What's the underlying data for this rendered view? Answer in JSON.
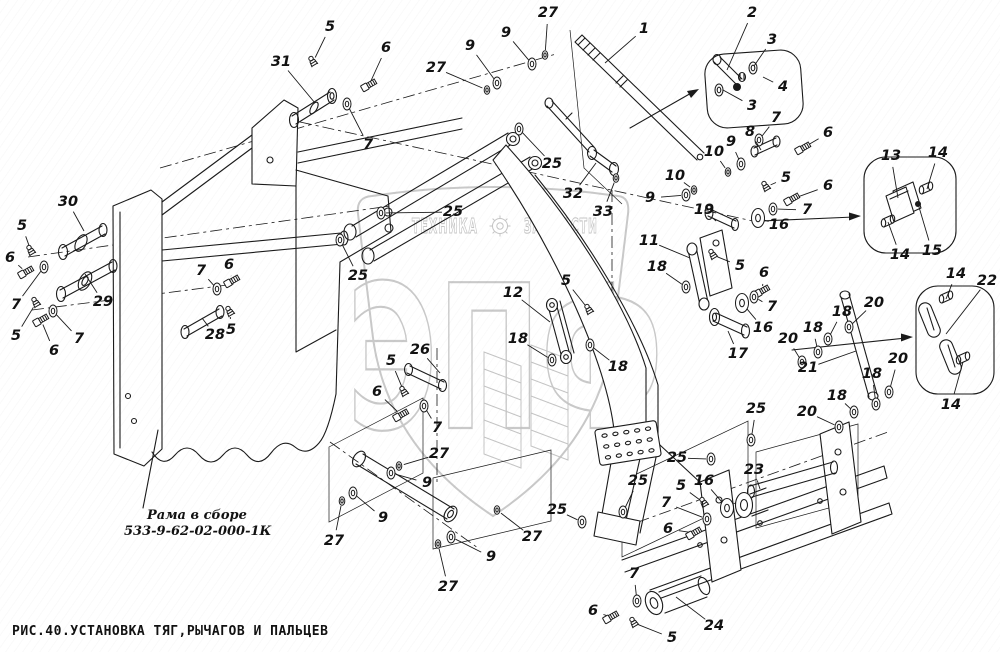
{
  "figure": {
    "caption": "РИС.40.УСТАНОВКА ТЯГ,РЫЧАГОВ И ПАЛЬЦЕВ",
    "frame_label": {
      "line1": "Рама в сборе",
      "line2": "533-9-62-02-000-1К"
    }
  },
  "watermark": {
    "word_left": "ТЕХНИКА",
    "word_right": "ЗАПЧАСТИ",
    "monogram": "ЭПФ",
    "gear_icon": "gear-icon",
    "color": "#c9c9c9"
  },
  "style": {
    "line_color": "#1a1a1a",
    "background": "#ffffff"
  },
  "callouts": [
    {
      "label": "5",
      "x": 330,
      "y": 27,
      "tx": 313,
      "ty": 62,
      "part": "fitting"
    },
    {
      "label": "6",
      "x": 386,
      "y": 48,
      "tx": 369,
      "ty": 85,
      "part": "bolt"
    },
    {
      "label": "31",
      "x": 281,
      "y": 62,
      "tx": 315,
      "ty": 103,
      "part": "none"
    },
    {
      "label": "7",
      "x": 368,
      "y": 145,
      "tx": 347,
      "ty": 104,
      "part": "washer"
    },
    {
      "label": "27",
      "x": 436,
      "y": 68,
      "tx": 487,
      "ty": 90,
      "part": "washer-s"
    },
    {
      "label": "9",
      "x": 470,
      "y": 46,
      "tx": 497,
      "ty": 83,
      "part": "washer"
    },
    {
      "label": "9",
      "x": 506,
      "y": 33,
      "tx": 532,
      "ty": 64,
      "part": "washer"
    },
    {
      "label": "27",
      "x": 548,
      "y": 13,
      "tx": 545,
      "ty": 55,
      "part": "washer-s"
    },
    {
      "label": "1",
      "x": 644,
      "y": 29,
      "tx": 605,
      "ty": 63,
      "part": "none"
    },
    {
      "label": "2",
      "x": 752,
      "y": 13,
      "tx": 727,
      "ty": 70,
      "part": "none"
    },
    {
      "label": "3",
      "x": 772,
      "y": 40,
      "tx": 754,
      "ty": 66,
      "part": "none"
    },
    {
      "label": "4",
      "x": 783,
      "y": 87,
      "tx": 763,
      "ty": 77,
      "part": "none"
    },
    {
      "label": "3",
      "x": 752,
      "y": 106,
      "tx": 723,
      "ty": 90,
      "part": "none"
    },
    {
      "label": "7",
      "x": 776,
      "y": 118,
      "tx": 759,
      "ty": 140,
      "part": "washer"
    },
    {
      "label": "6",
      "x": 828,
      "y": 133,
      "tx": 803,
      "ty": 148,
      "part": "bolt"
    },
    {
      "label": "8",
      "x": 750,
      "y": 132,
      "tx": 761,
      "ty": 150,
      "part": "none"
    },
    {
      "label": "9",
      "x": 731,
      "y": 142,
      "tx": 741,
      "ty": 164,
      "part": "washer"
    },
    {
      "label": "10",
      "x": 714,
      "y": 152,
      "tx": 728,
      "ty": 172,
      "part": "washer-s"
    },
    {
      "label": "10",
      "x": 675,
      "y": 176,
      "tx": 694,
      "ty": 190,
      "part": "washer-s"
    },
    {
      "label": "9",
      "x": 650,
      "y": 198,
      "tx": 686,
      "ty": 195,
      "part": "washer"
    },
    {
      "label": "5",
      "x": 786,
      "y": 178,
      "tx": 766,
      "ty": 187,
      "part": "fitting"
    },
    {
      "label": "6",
      "x": 828,
      "y": 186,
      "tx": 792,
      "ty": 199,
      "part": "bolt"
    },
    {
      "label": "7",
      "x": 807,
      "y": 210,
      "tx": 773,
      "ty": 209,
      "part": "washer"
    },
    {
      "label": "19",
      "x": 704,
      "y": 210,
      "tx": 716,
      "ty": 221,
      "part": "none"
    },
    {
      "label": "16",
      "x": 779,
      "y": 225,
      "tx": 758,
      "ty": 218,
      "part": "washer-b"
    },
    {
      "label": "13",
      "x": 891,
      "y": 156,
      "tx": 898,
      "ty": 198,
      "part": "none"
    },
    {
      "label": "14",
      "x": 938,
      "y": 153,
      "tx": 927,
      "ty": 189,
      "part": "none"
    },
    {
      "label": "15",
      "x": 932,
      "y": 251,
      "tx": 919,
      "ty": 207,
      "part": "none"
    },
    {
      "label": "14",
      "x": 900,
      "y": 255,
      "tx": 888,
      "ty": 222,
      "part": "none"
    },
    {
      "label": "14",
      "x": 956,
      "y": 274,
      "tx": 946,
      "ty": 299,
      "part": "none"
    },
    {
      "label": "22",
      "x": 987,
      "y": 281,
      "tx": 946,
      "ty": 334,
      "part": "none"
    },
    {
      "label": "14",
      "x": 951,
      "y": 405,
      "tx": 963,
      "ty": 362,
      "part": "none"
    },
    {
      "label": "20",
      "x": 874,
      "y": 303,
      "tx": 849,
      "ty": 327,
      "part": "washer"
    },
    {
      "label": "18",
      "x": 842,
      "y": 312,
      "tx": 828,
      "ty": 339,
      "part": "washer"
    },
    {
      "label": "18",
      "x": 813,
      "y": 328,
      "tx": 818,
      "ty": 352,
      "part": "washer"
    },
    {
      "label": "20",
      "x": 788,
      "y": 339,
      "tx": 802,
      "ty": 362,
      "part": "washer"
    },
    {
      "label": "21",
      "x": 808,
      "y": 368,
      "tx": 856,
      "ty": 351,
      "part": "none"
    },
    {
      "label": "20",
      "x": 898,
      "y": 359,
      "tx": 889,
      "ty": 392,
      "part": "washer"
    },
    {
      "label": "18",
      "x": 872,
      "y": 374,
      "tx": 876,
      "ty": 404,
      "part": "washer"
    },
    {
      "label": "18",
      "x": 837,
      "y": 396,
      "tx": 854,
      "ty": 412,
      "part": "washer"
    },
    {
      "label": "20",
      "x": 807,
      "y": 412,
      "tx": 839,
      "ty": 427,
      "part": "washer"
    },
    {
      "label": "32",
      "x": 573,
      "y": 194,
      "tx": 596,
      "ty": 163,
      "part": "none"
    },
    {
      "label": "33",
      "x": 603,
      "y": 212,
      "tx": 616,
      "ty": 178,
      "part": "washer-s"
    },
    {
      "label": "11",
      "x": 649,
      "y": 241,
      "tx": 690,
      "ty": 258,
      "part": "none"
    },
    {
      "label": "18",
      "x": 657,
      "y": 267,
      "tx": 686,
      "ty": 287,
      "part": "washer"
    },
    {
      "label": "5",
      "x": 740,
      "y": 266,
      "tx": 713,
      "ty": 255,
      "part": "fitting"
    },
    {
      "label": "6",
      "x": 764,
      "y": 273,
      "tx": 762,
      "ty": 291,
      "part": "bolt"
    },
    {
      "label": "7",
      "x": 772,
      "y": 307,
      "tx": 754,
      "ty": 297,
      "part": "washer"
    },
    {
      "label": "16",
      "x": 763,
      "y": 328,
      "tx": 742,
      "ty": 303,
      "part": "washer-b"
    },
    {
      "label": "17",
      "x": 738,
      "y": 354,
      "tx": 728,
      "ty": 331,
      "part": "none"
    },
    {
      "label": "12",
      "x": 513,
      "y": 293,
      "tx": 550,
      "ty": 322,
      "part": "none"
    },
    {
      "label": "5",
      "x": 566,
      "y": 281,
      "tx": 589,
      "ty": 310,
      "part": "fitting"
    },
    {
      "label": "18",
      "x": 518,
      "y": 339,
      "tx": 552,
      "ty": 360,
      "part": "washer"
    },
    {
      "label": "18",
      "x": 618,
      "y": 367,
      "tx": 590,
      "ty": 345,
      "part": "washer"
    },
    {
      "label": "25",
      "x": 552,
      "y": 164,
      "tx": 519,
      "ty": 129,
      "part": "washer"
    },
    {
      "label": "25",
      "x": 453,
      "y": 212,
      "tx": 381,
      "ty": 213,
      "part": "washer"
    },
    {
      "label": "25",
      "x": 358,
      "y": 276,
      "tx": 340,
      "ty": 240,
      "part": "washer"
    },
    {
      "label": "26",
      "x": 420,
      "y": 350,
      "tx": 440,
      "ty": 373,
      "part": "none"
    },
    {
      "label": "5",
      "x": 391,
      "y": 361,
      "tx": 404,
      "ty": 392,
      "part": "fitting"
    },
    {
      "label": "6",
      "x": 377,
      "y": 392,
      "tx": 401,
      "ty": 415,
      "part": "bolt"
    },
    {
      "label": "7",
      "x": 437,
      "y": 428,
      "tx": 424,
      "ty": 406,
      "part": "washer"
    },
    {
      "label": "27",
      "x": 439,
      "y": 454,
      "tx": 399,
      "ty": 466,
      "part": "washer-s"
    },
    {
      "label": "9",
      "x": 427,
      "y": 483,
      "tx": 391,
      "ty": 473,
      "part": "washer"
    },
    {
      "label": "9",
      "x": 383,
      "y": 518,
      "tx": 353,
      "ty": 493,
      "part": "washer"
    },
    {
      "label": "27",
      "x": 334,
      "y": 541,
      "tx": 342,
      "ty": 501,
      "part": "washer-s"
    },
    {
      "label": "27",
      "x": 532,
      "y": 537,
      "tx": 497,
      "ty": 510,
      "part": "washer-s"
    },
    {
      "label": "9",
      "x": 491,
      "y": 557,
      "tx": 451,
      "ty": 537,
      "part": "washer"
    },
    {
      "label": "27",
      "x": 448,
      "y": 587,
      "tx": 438,
      "ty": 544,
      "part": "washer-s"
    },
    {
      "label": "25",
      "x": 557,
      "y": 510,
      "tx": 582,
      "ty": 522,
      "part": "washer"
    },
    {
      "label": "25",
      "x": 638,
      "y": 481,
      "tx": 623,
      "ty": 512,
      "part": "washer"
    },
    {
      "label": "25",
      "x": 677,
      "y": 458,
      "tx": 711,
      "ty": 459,
      "part": "washer"
    },
    {
      "label": "25",
      "x": 756,
      "y": 409,
      "tx": 751,
      "ty": 440,
      "part": "washer"
    },
    {
      "label": "23",
      "x": 754,
      "y": 470,
      "tx": 760,
      "ty": 489,
      "part": "none"
    },
    {
      "label": "16",
      "x": 704,
      "y": 481,
      "tx": 727,
      "ty": 508,
      "part": "washer-b"
    },
    {
      "label": "5",
      "x": 681,
      "y": 486,
      "tx": 704,
      "ty": 503,
      "part": "fitting"
    },
    {
      "label": "7",
      "x": 666,
      "y": 503,
      "tx": 707,
      "ty": 519,
      "part": "washer"
    },
    {
      "label": "6",
      "x": 668,
      "y": 529,
      "tx": 694,
      "ty": 533,
      "part": "bolt"
    },
    {
      "label": "7",
      "x": 634,
      "y": 574,
      "tx": 637,
      "ty": 601,
      "part": "washer"
    },
    {
      "label": "6",
      "x": 593,
      "y": 611,
      "tx": 611,
      "ty": 617,
      "part": "bolt"
    },
    {
      "label": "5",
      "x": 672,
      "y": 638,
      "tx": 634,
      "ty": 623,
      "part": "fitting"
    },
    {
      "label": "24",
      "x": 714,
      "y": 626,
      "tx": 676,
      "ty": 597,
      "part": "none"
    },
    {
      "label": "30",
      "x": 68,
      "y": 202,
      "tx": 84,
      "ty": 231,
      "part": "none"
    },
    {
      "label": "5",
      "x": 22,
      "y": 226,
      "tx": 31,
      "ty": 251,
      "part": "fitting"
    },
    {
      "label": "6",
      "x": 10,
      "y": 258,
      "tx": 26,
      "ty": 272,
      "part": "bolt"
    },
    {
      "label": "7",
      "x": 16,
      "y": 305,
      "tx": 44,
      "ty": 267,
      "part": "washer"
    },
    {
      "label": "5",
      "x": 16,
      "y": 336,
      "tx": 36,
      "ty": 303,
      "part": "fitting"
    },
    {
      "label": "6",
      "x": 54,
      "y": 351,
      "tx": 41,
      "ty": 320,
      "part": "bolt"
    },
    {
      "label": "7",
      "x": 79,
      "y": 339,
      "tx": 53,
      "ty": 311,
      "part": "washer"
    },
    {
      "label": "29",
      "x": 103,
      "y": 302,
      "tx": 85,
      "ty": 274,
      "part": "none"
    },
    {
      "label": "28",
      "x": 215,
      "y": 335,
      "tx": 202,
      "ty": 318,
      "part": "none"
    },
    {
      "label": "7",
      "x": 201,
      "y": 271,
      "tx": 217,
      "ty": 289,
      "part": "washer"
    },
    {
      "label": "6",
      "x": 229,
      "y": 265,
      "tx": 232,
      "ty": 281,
      "part": "bolt"
    },
    {
      "label": "5",
      "x": 231,
      "y": 330,
      "tx": 230,
      "ty": 312,
      "part": "fitting"
    }
  ]
}
